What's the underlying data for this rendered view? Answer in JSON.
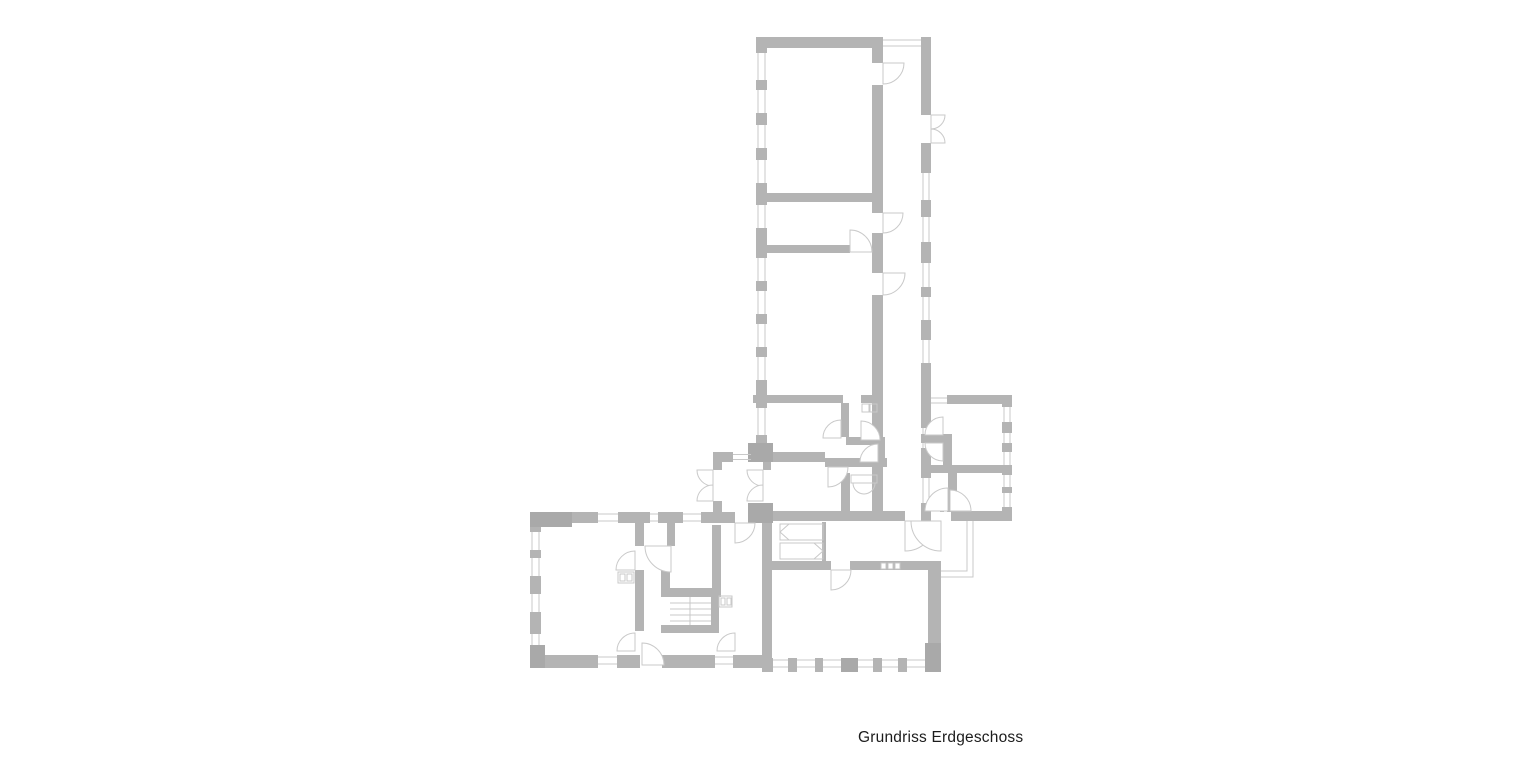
{
  "caption": {
    "text": "Grundriss Erdgeschoss"
  },
  "colors": {
    "background": "#ffffff",
    "wall": "#b4b4b4",
    "wall_dark": "#a9a9a9",
    "line": "#c9c9c9",
    "text": "#1c1c1c"
  },
  "plan": {
    "type": "architectural-floor-plan",
    "storey": "Erdgeschoss",
    "wings": [
      "north wing: corridor with three rooms and bathroom/wc",
      "east wing: two small rooms with lobby",
      "south-west wing: large room, staircase hall",
      "south wing: entrance hall with wardrobes and large room"
    ],
    "features": [
      "windows in exterior walls",
      "door swing arcs",
      "double-door entrances (west vestibule, south porch, east balcony)",
      "staircase",
      "sanitary fixtures",
      "built-in wardrobes",
      "exterior entrance steps"
    ]
  }
}
